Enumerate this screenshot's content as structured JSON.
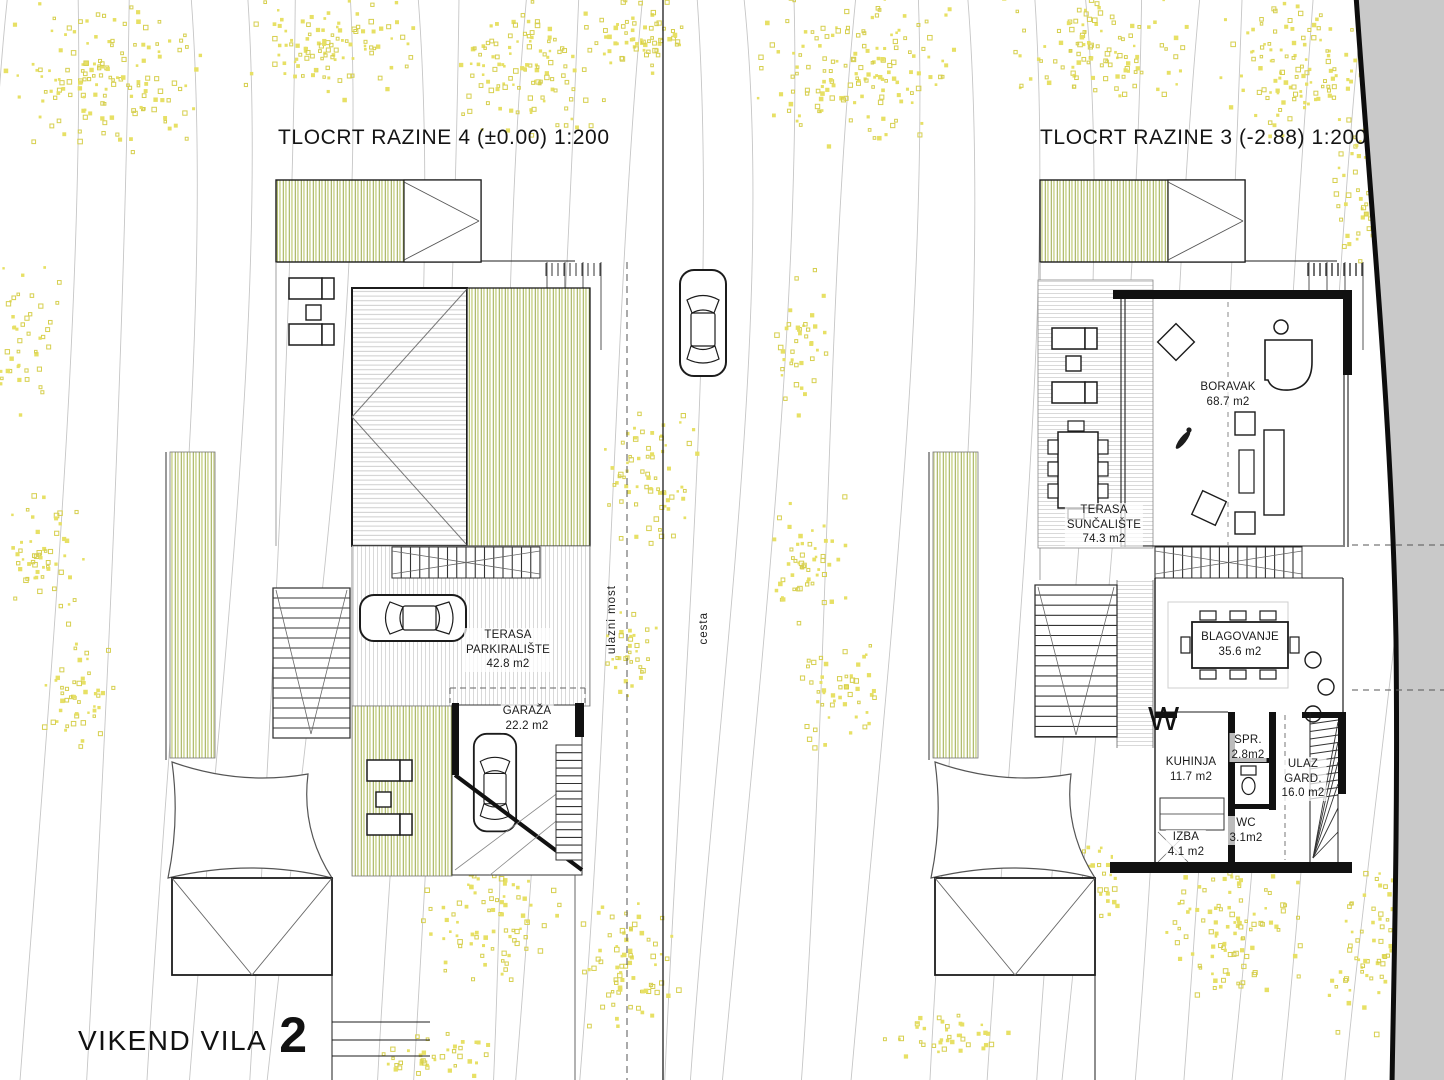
{
  "titles": {
    "left_plan": "TLOCRT RAZINE 4 (±0.00) 1:200",
    "right_plan": "TLOCRT RAZINE 3 (-2.88) 1:200",
    "project_name": "VIKEND VILA",
    "project_number": "2"
  },
  "site_labels": {
    "entry_bridge": "ulazni most",
    "road": "cesta",
    "washer_mark": "W"
  },
  "rooms_level4": [
    {
      "id": "terasa-parkiraliste",
      "name": "TERASA\nPARKIRALIŠTE",
      "area": "42.8 m2"
    },
    {
      "id": "garaza",
      "name": "GARAŽA",
      "area": "22.2 m2"
    }
  ],
  "rooms_level3": [
    {
      "id": "boravak",
      "name": "BORAVAK",
      "area": "68.7 m2"
    },
    {
      "id": "terasa-suncaliste",
      "name": "TERASA\nSUNČALIŠTE",
      "area": "74.3 m2"
    },
    {
      "id": "blagovanje",
      "name": "BLAGOVANJE",
      "area": "35.6 m2"
    },
    {
      "id": "kuhinja",
      "name": "KUHINJA",
      "area": "11.7 m2"
    },
    {
      "id": "spr",
      "name": "SPR.",
      "area": "2.8m2"
    },
    {
      "id": "ulaz-gard",
      "name": "ULAZ\nGARD.",
      "area": "16.0 m2"
    },
    {
      "id": "wc",
      "name": "WC",
      "area": "3.1m2"
    },
    {
      "id": "izba",
      "name": "IZBA",
      "area": "4.1 m2"
    }
  ],
  "colors": {
    "ink": "#1c1c1c",
    "wall": "#111111",
    "thin_line": "#555555",
    "contour": "#c6c6c6",
    "road_fill": "#c9c9c9",
    "road_edge": "#0d0d0d",
    "deck_green_dark": "#a3b156",
    "deck_green_light": "#ccd48e",
    "stripe_gray": "#d9d9d9",
    "roof_hatch": "#c9c9c9",
    "tree_yellow": "#e7e065",
    "tree_yellow_stroke": "#d6cf4e"
  }
}
